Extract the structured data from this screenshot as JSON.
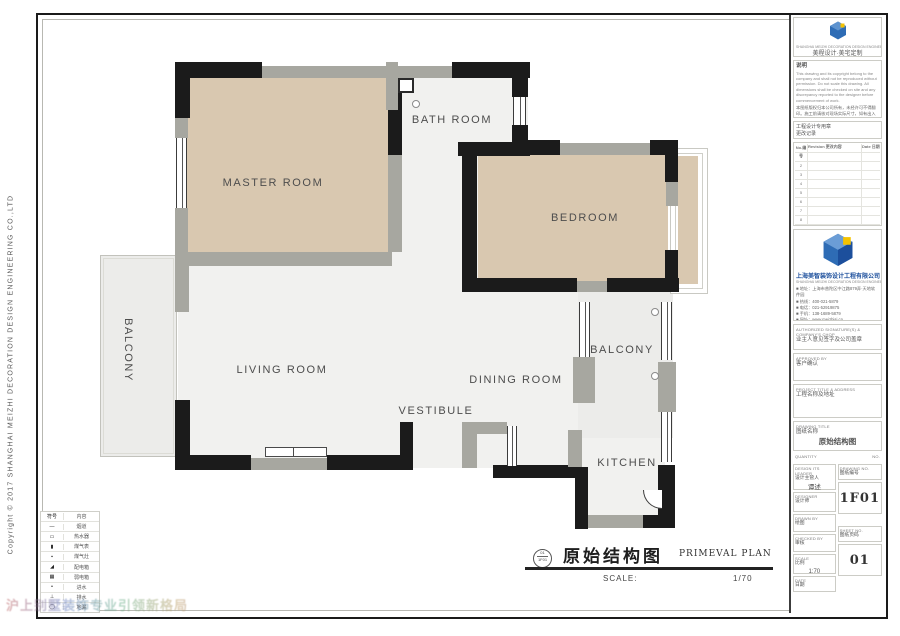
{
  "sheet": {
    "copyright_vertical": "Copyright © 2017 SHANGHAI MEIZHI DECORATION DESIGN ENGINEERING CO.,LTD",
    "watermark": "沪上别墅装饰专业引领新格局"
  },
  "plan": {
    "labels": {
      "master": "MASTER ROOM",
      "bath": "BATH ROOM",
      "bedroom": "BEDROOM",
      "balcony_left": "BALCONY",
      "living": "LIVING ROOM",
      "dining": "DINING ROOM",
      "vestibule": "VESTIBULE",
      "balcony_right": "BALCONY",
      "kitchen": "KITCHEN"
    },
    "colors": {
      "wall": "#1b1b1b",
      "wall_infill": "#a7a7a0",
      "room_beige": "#d9c8b0",
      "room_light": "#f1f1ef"
    }
  },
  "legend": {
    "header": {
      "symbol": "符号",
      "content": "内容"
    },
    "rows": [
      {
        "symbol": "—",
        "label": "烟道"
      },
      {
        "symbol": "▭",
        "label": "热水器"
      },
      {
        "symbol": "▮",
        "label": "煤气表"
      },
      {
        "symbol": "▪",
        "label": "煤气灶"
      },
      {
        "symbol": "◢",
        "label": "配电箱"
      },
      {
        "symbol": "▦",
        "label": "弱电箱"
      },
      {
        "symbol": "•",
        "label": "进水"
      },
      {
        "symbol": "⊥",
        "label": "排水"
      },
      {
        "symbol": "◯",
        "label": "地漏"
      }
    ]
  },
  "title_bar": {
    "ref_top": "01",
    "ref_bottom": "1F01",
    "title_cn": "原始结构图",
    "title_en": "PRIMEVAL PLAN",
    "scale_label": "SCALE:",
    "scale_value": "1/70"
  },
  "title_block": {
    "tagline": "美程设计·美宅定制",
    "notes_title": "说明",
    "notes_en": "This drawing and its copyright belong to the company and shall not be reproduced without permission. Do not scale this drawing. All dimensions shall be checked on site and any discrepancy reported to the designer before commencement of work.",
    "notes_cn": "本图纸版权归本公司所有，未经许可不得翻印。施工前请核对现场实际尺寸，如有出入请及时通知设计师协调解决。",
    "stamp_label": "工程设计专用章",
    "revision_title": "更改记录",
    "revision_headers": {
      "no": "No.编号",
      "revision": "Revision 更改内容",
      "date": "Date 日期"
    },
    "revision_rows": [
      "1",
      "2",
      "3",
      "4",
      "5",
      "6",
      "7",
      "8"
    ],
    "company_name_cn": "上海美智装饰设计工程有限公司",
    "company_name_en": "SHANGHAI MEIZHI DECORATION DESIGN ENGINEERING CO.,LTD",
    "company_lines": "■ 地址：上海市普陀区中江路879弄·天地软件园\n■ 热线：400-021-5879\n■ 电话：021-52919875\n■ 手机：138-1689-5879\n■ 网址：www.meizhisj.cn",
    "authorized_label_en": "AUTHORIZED SIGNATURE(S) & COMPANY'S CHOP",
    "authorized_label_cn": "业主人意见签字及公司盖章",
    "approved_label_en": "APPROVED BY",
    "approved_label_cn": "客户确认",
    "project_label_en": "PROJECT TITLE & ADDRESS",
    "project_label_cn": "工程名称及地址",
    "drawing_title_label_en": "DRAWING TITLE",
    "drawing_title_label_cn": "图纸名称",
    "drawing_title_value": "原始结构图",
    "quantity_label": "QUANTITY",
    "no_label": "NO.",
    "design_leader_label_en": "DESIGN ITS LEADER",
    "design_leader_label_cn": "设计主管人",
    "design_leader_value": "谭述",
    "drawing_no_label_en": "DRAWING NO.",
    "drawing_no_label_cn": "图纸编号",
    "drawing_no_value": "1F01",
    "designer_label_en": "DESIGNER",
    "designer_label_cn": "设计师",
    "drawn_label_en": "DRAWN BY",
    "drawn_label_cn": "绘图",
    "checked_label_en": "CHECKED BY",
    "checked_label_cn": "审核",
    "sheet_no_label_en": "SHEET NO.",
    "sheet_no_label_cn": "图纸页码",
    "sheet_no_value": "01",
    "scale_label_en": "SCALE",
    "scale_label_cn": "比例",
    "scale_value": "1:70",
    "date_label_en": "DATE",
    "date_label_cn": "日期"
  }
}
